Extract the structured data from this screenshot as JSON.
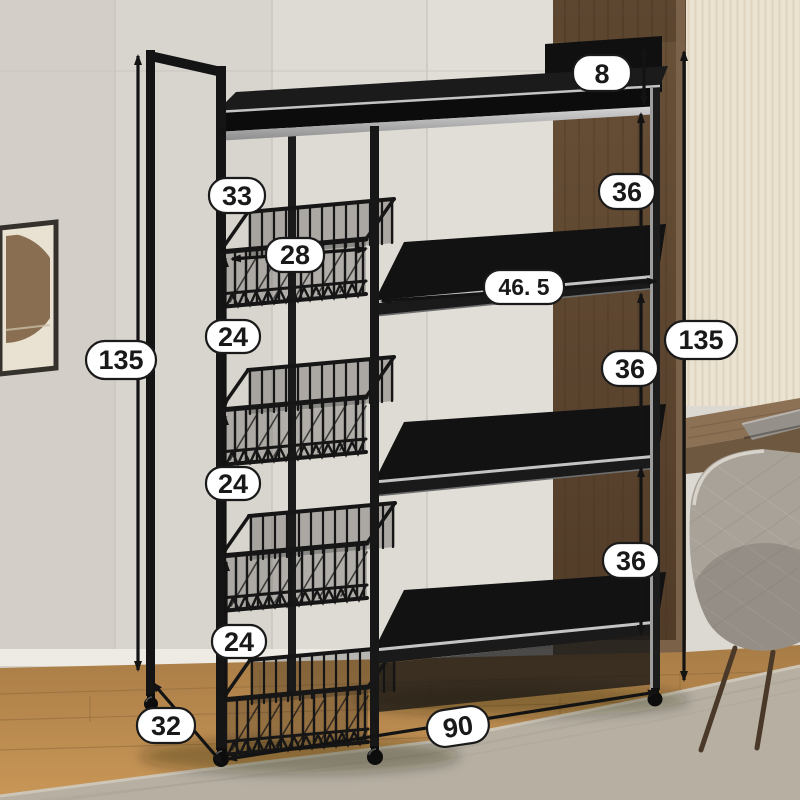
{
  "dimensions": {
    "top_rail_height": "8",
    "top_gap": "33",
    "basket_width": "28",
    "basket_gap_1": "24",
    "basket_gap_2": "24",
    "basket_gap_3": "24",
    "height_left": "135",
    "height_right": "135",
    "shelf_gap_1": "36",
    "shelf_gap_2": "36",
    "shelf_gap_3": "36",
    "shelf_width": "46. 5",
    "total_width": "90",
    "depth": "32"
  },
  "palette": {
    "annotation_ink": "#131313",
    "pill_fill": "#ffffff",
    "rack_black": "#161616",
    "steel_highlight": "#c6c6c6",
    "wall": "#dcd8d2",
    "wood_panel": "#5e4733",
    "wallpaper": "#ebe3d2",
    "wood_floor": "#b5894f",
    "rug": "#b6afa2",
    "desk_wood": "#8c7155",
    "chair_fabric": "#a8a299",
    "frame_art": "#8a6e51"
  }
}
